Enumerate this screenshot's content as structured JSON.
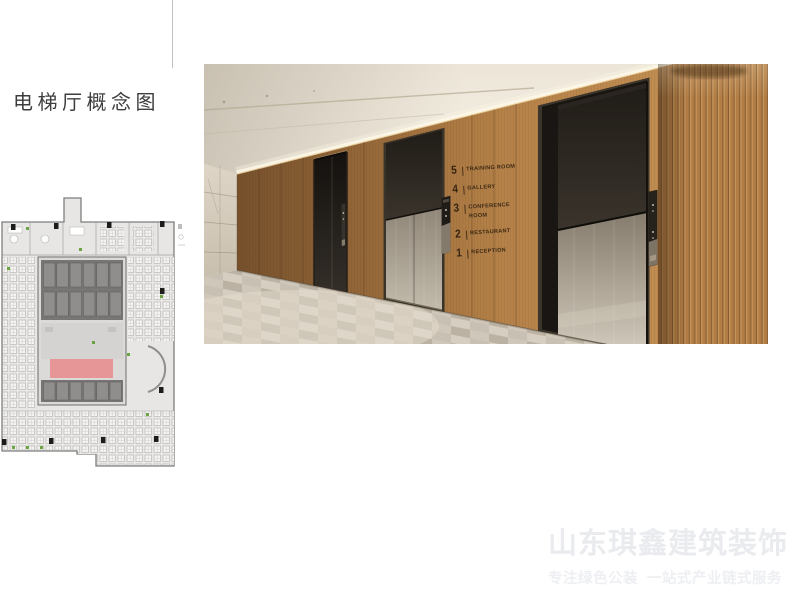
{
  "slide": {
    "title": "电梯厅概念图"
  },
  "watermark": {
    "brand": "山东琪鑫建筑装饰",
    "tagline": "专注绿色公装  一站式产业链式服务"
  },
  "photo": {
    "directory": {
      "rows": [
        {
          "floor": "5",
          "label": "TRAINING ROOM"
        },
        {
          "floor": "4",
          "label": "GALLERY"
        },
        {
          "floor": "3",
          "label": "CONFERENCE ROOM"
        },
        {
          "floor": "2",
          "label": "RESTAURANT"
        },
        {
          "floor": "1",
          "label": "RECEPTION"
        }
      ]
    },
    "colors": {
      "wood": "#b5834a",
      "wood_shadow": "#845a30",
      "metal": "#b3aa9b",
      "stone": "#d6cdbf",
      "ceiling": "#f3eee3",
      "carpet": "#cfc7ba",
      "recess": "#1c1814"
    }
  },
  "floor_plan": {
    "highlight_color": "#e69697"
  }
}
